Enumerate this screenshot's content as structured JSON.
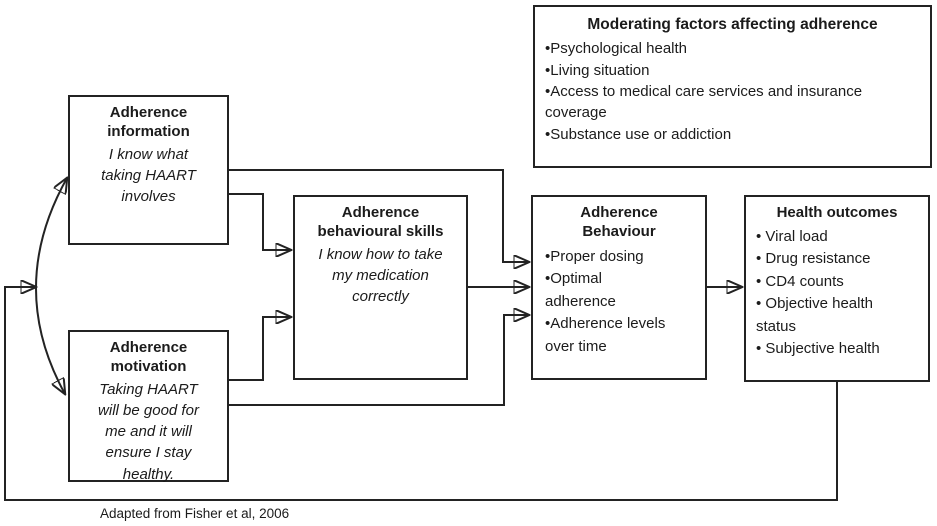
{
  "colors": {
    "line": "#232323",
    "text": "#1b1b1b",
    "background": "#ffffff"
  },
  "caption": "Adapted from Fisher et al, 2006",
  "boxes": {
    "moderating": {
      "title": "Moderating factors affecting adherence",
      "bullets": [
        "•Psychological health",
        "•Living situation",
        "•Access to medical care services and insurance coverage",
        "•Substance use or addiction"
      ]
    },
    "information": {
      "title": "Adherence information",
      "body": "I know what taking HAART involves"
    },
    "motivation": {
      "title": "Adherence motivation",
      "body": "Taking HAART will be good for me and it will ensure I stay healthy."
    },
    "skills": {
      "title": "Adherence behavioural skills",
      "body": "I know how to take my medication correctly"
    },
    "behaviour": {
      "title": "Adherence Behaviour",
      "bullets": [
        "•Proper dosing",
        "•Optimal adherence",
        "•Adherence levels over time"
      ]
    },
    "outcomes": {
      "title": "Health outcomes",
      "bullets": [
        "• Viral load",
        "• Drug resistance",
        "• CD4 counts",
        "• Objective health status",
        "• Subjective health"
      ]
    }
  },
  "edges": [
    {
      "from": "adherence-information",
      "to": "adherence-behavioural-skills",
      "type": "arrow"
    },
    {
      "from": "adherence-information",
      "to": "adherence-behaviour",
      "type": "arrow"
    },
    {
      "from": "adherence-motivation",
      "to": "adherence-behavioural-skills",
      "type": "arrow"
    },
    {
      "from": "adherence-motivation",
      "to": "adherence-behaviour",
      "type": "arrow"
    },
    {
      "from": "adherence-behavioural-skills",
      "to": "adherence-behaviour",
      "type": "arrow"
    },
    {
      "from": "adherence-behaviour",
      "to": "health-outcomes",
      "type": "arrow"
    },
    {
      "from": "health-outcomes",
      "to": "information-motivation-link",
      "type": "feedback-arrow"
    },
    {
      "from": "adherence-information",
      "to": "adherence-motivation",
      "type": "bidirectional-arc"
    }
  ]
}
